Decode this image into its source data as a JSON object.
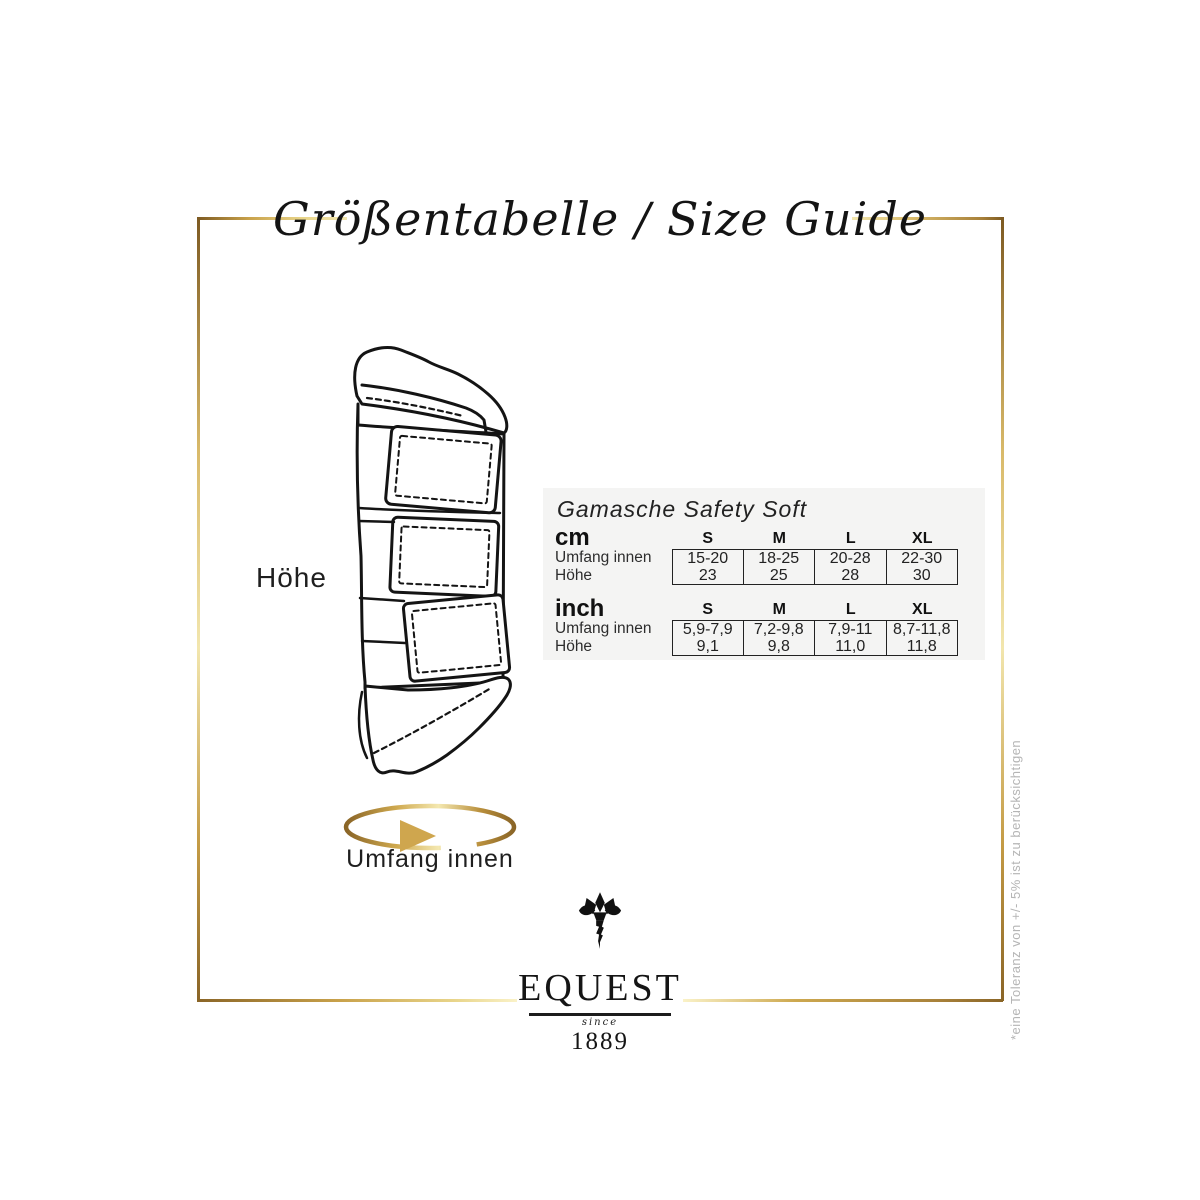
{
  "title": "Größentabelle / Size Guide",
  "diagram": {
    "height_label": "Höhe",
    "circumference_label": "Umfang innen"
  },
  "size_table": {
    "product_title": "Gamasche Safety Soft",
    "sections": [
      {
        "unit": "cm",
        "sizes": [
          "S",
          "M",
          "L",
          "XL"
        ],
        "rows": [
          {
            "label": "Umfang innen",
            "values": [
              "15-20",
              "18-25",
              "20-28",
              "22-30"
            ]
          },
          {
            "label": "Höhe",
            "values": [
              "23",
              "25",
              "28",
              "30"
            ]
          }
        ]
      },
      {
        "unit": "inch",
        "sizes": [
          "S",
          "M",
          "L",
          "XL"
        ],
        "rows": [
          {
            "label": "Umfang innen",
            "values": [
              "5,9-7,9",
              "7,2-9,8",
              "7,9-11",
              "8,7-11,8"
            ]
          },
          {
            "label": "Höhe",
            "values": [
              "9,1",
              "9,8",
              "11,0",
              "11,8"
            ]
          }
        ]
      }
    ]
  },
  "logo": {
    "brand": "EQUEST",
    "since_label": "since",
    "year": "1889",
    "icon": "thistle-icon"
  },
  "footnote": "*eine Toleranz von +/- 5% ist zu berücksichtigen",
  "colors": {
    "gold": "#c9a24b",
    "gold_light": "#f2e6ae",
    "gold_dark": "#7d5a22",
    "ink": "#1a1a1a",
    "panel_bg": "#f4f4f3",
    "footnote_gray": "#b5b5b5"
  }
}
